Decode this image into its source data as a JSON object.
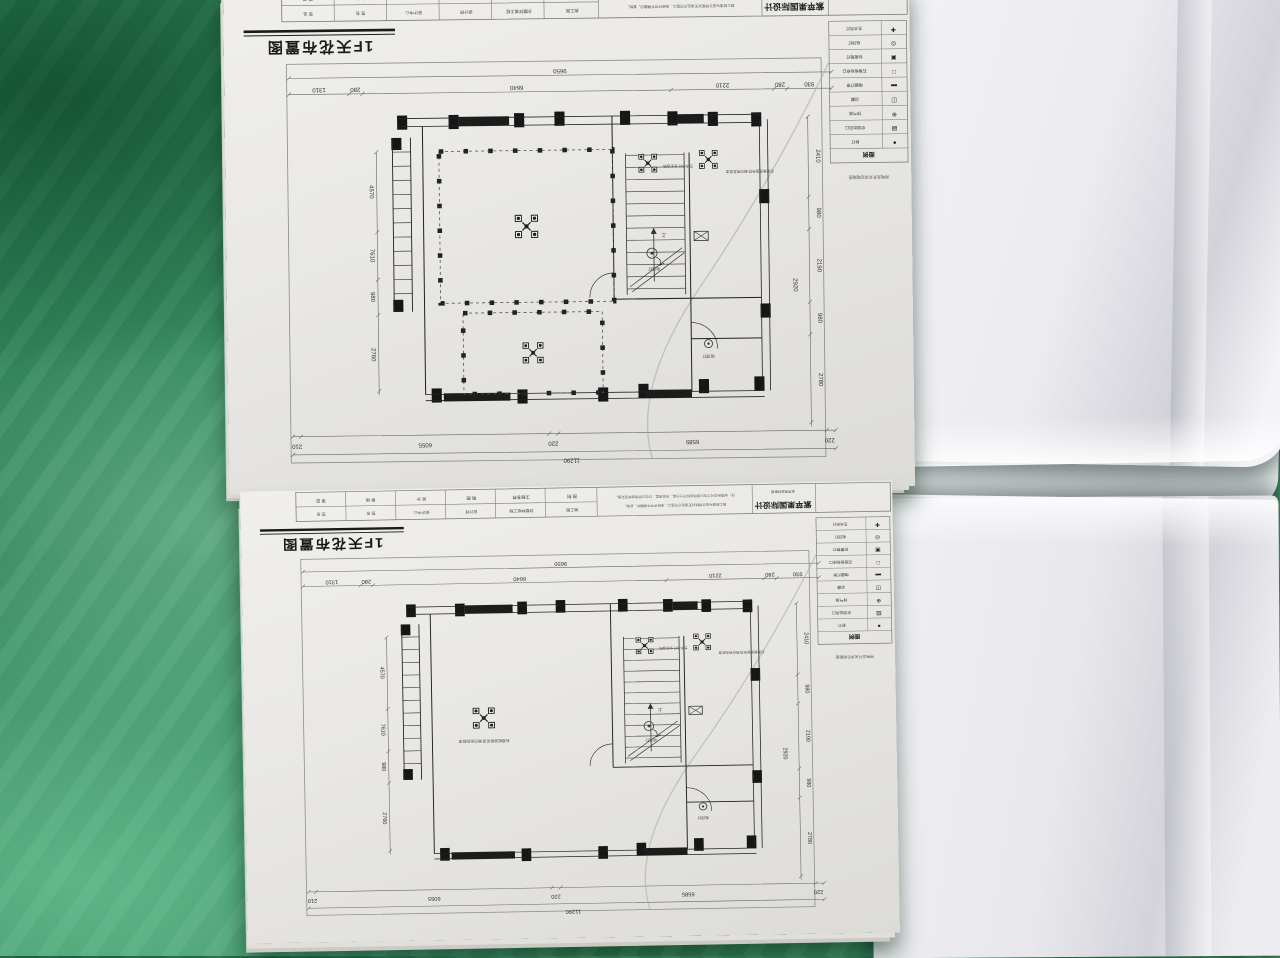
{
  "sheet": {
    "title": "1F天花布置图",
    "company": "紫苹果国际设计",
    "company_sub": "紫苹果装饰集团",
    "note_line1": "注：本图所注尺寸均以现场实际尺寸为准，天花造型、灯位以现场放样后实施。",
    "note_line2": "施工前请与设计师核对无误后方可施工，未经许可不得翻印、复制。",
    "stamp_line": "用电及开关详见电路图",
    "titleblock": {
      "cells": [
        {
          "label": "审 定",
          "value": "签 名"
        },
        {
          "label": "审 核",
          "value": "签 名"
        },
        {
          "label": "设 计",
          "value": "设计中心"
        },
        {
          "label": "制 图",
          "value": "设计师"
        },
        {
          "label": "工程名称",
          "value": "别墅样板工程"
        },
        {
          "label": "图 别",
          "value": "施工图"
        }
      ]
    },
    "legend": {
      "header": "图例",
      "items": [
        {
          "symbol": "✚",
          "label": "艺术吊灯"
        },
        {
          "symbol": "◎",
          "label": "吸顶灯"
        },
        {
          "symbol": "▣",
          "label": "防雾筒灯"
        },
        {
          "symbol": "□",
          "label": "石膏板检修口"
        },
        {
          "symbol": "▬",
          "label": "暗藏灯带"
        },
        {
          "symbol": "◫",
          "label": "浴霸"
        },
        {
          "symbol": "⊕",
          "label": "排气扇"
        },
        {
          "symbol": "▤",
          "label": "空调出风口"
        },
        {
          "symbol": "●",
          "label": "射灯"
        }
      ]
    },
    "labels": {
      "chandelier_label_1": "艺术吊灯 业主自购",
      "chandelier_label_2": "石膏板造型吊顶 刷白色乳胶漆",
      "lamp_label": "吸顶灯",
      "stair_label": "上"
    },
    "dims": {
      "top_total": "9650",
      "top_segments": [
        "1310",
        "280",
        "6640",
        "2210",
        "280",
        "930"
      ],
      "bottom_total": "11290",
      "bottom_segments": [
        "210",
        "6055",
        "220",
        "6585",
        "220"
      ],
      "right_segments": [
        "2410",
        "980",
        "2190",
        "980",
        "2780"
      ],
      "right_inner": "2920",
      "left_segments": [
        "4570",
        "7610",
        "980",
        "2760"
      ]
    }
  }
}
